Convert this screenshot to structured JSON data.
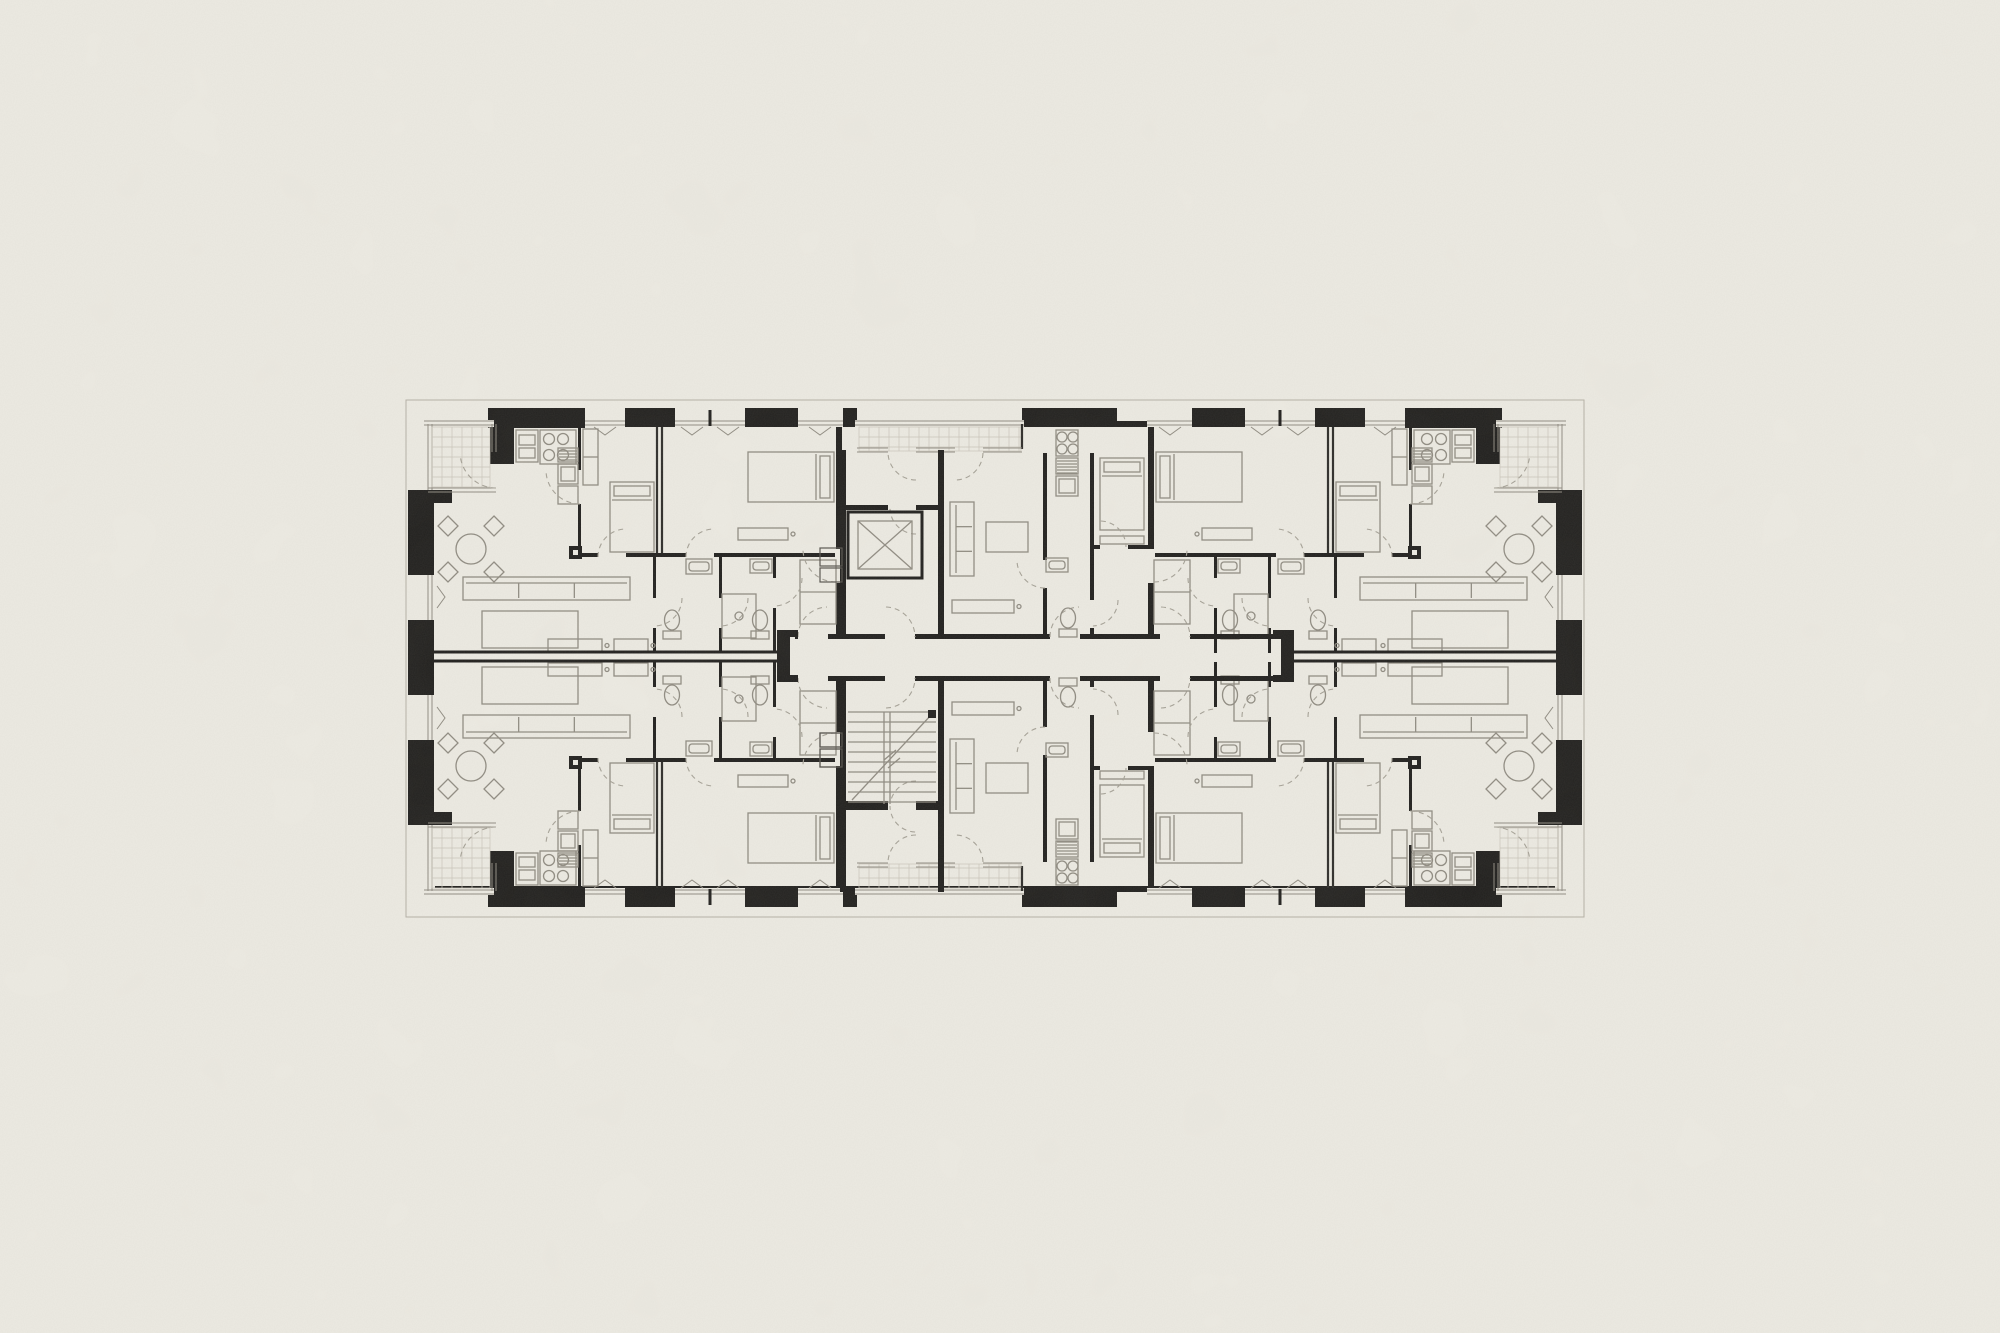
{
  "canvas": {
    "width": 2000,
    "height": 1333
  },
  "colors": {
    "paper": "#edebe3",
    "ink": "#1f1e1c",
    "furniture": "#8f8b81",
    "tile": "#c9c5ba"
  },
  "plan": {
    "x": 418,
    "y": 408,
    "width": 1154,
    "height": 499,
    "mirror_x": 995,
    "mirror_y": 657.5
  },
  "drawing": {
    "envelope": [
      [
        "r",
        406,
        400,
        1178,
        517,
        "prop"
      ],
      [
        "r",
        428,
        421,
        1134,
        6,
        "w"
      ],
      [
        "r",
        428,
        886,
        1134,
        6,
        "w"
      ],
      [
        "r",
        428,
        421,
        6,
        471,
        "w"
      ],
      [
        "r",
        1556,
        421,
        6,
        471,
        "w"
      ]
    ],
    "corner_apartment": [
      [
        "r",
        488,
        408,
        97,
        20,
        "w"
      ],
      [
        "r",
        490,
        428,
        24,
        36,
        "w"
      ],
      [
        "r",
        625,
        408,
        50,
        19,
        "w"
      ],
      [
        "r",
        745,
        408,
        53,
        19,
        "w"
      ],
      [
        "r",
        408,
        490,
        44,
        13,
        "w"
      ],
      [
        "r",
        408,
        503,
        24,
        72,
        "w"
      ],
      [
        "r",
        408,
        620,
        24,
        38,
        "w"
      ],
      [
        "r",
        578,
        427,
        3,
        129,
        "w"
      ],
      [
        "l",
        657,
        427,
        657,
        556,
        "t"
      ],
      [
        "l",
        662,
        427,
        662,
        556,
        "t"
      ],
      [
        "r",
        836,
        427,
        6,
        210,
        "w"
      ],
      [
        "r",
        578,
        553,
        264,
        4,
        "w"
      ],
      [
        "r",
        653,
        557,
        3,
        96,
        "w"
      ],
      [
        "r",
        719,
        557,
        3,
        96,
        "w"
      ],
      [
        "r",
        773,
        557,
        3,
        96,
        "w"
      ],
      [
        "r",
        577,
        470,
        5,
        34,
        "p"
      ],
      [
        "r",
        835,
        549,
        8,
        34,
        "p"
      ],
      [
        "r",
        598,
        553,
        28,
        4,
        "p"
      ],
      [
        "r",
        686,
        553,
        28,
        4,
        "p"
      ],
      [
        "r",
        653,
        598,
        3,
        30,
        "p"
      ],
      [
        "r",
        719,
        598,
        3,
        30,
        "p"
      ],
      [
        "r",
        773,
        578,
        3,
        30,
        "p"
      ],
      [
        "r",
        585,
        420,
        40,
        7,
        "p"
      ],
      [
        "dh",
        585,
        625,
        423
      ],
      [
        "vent",
        605,
        427,
        "s"
      ],
      [
        "r",
        675,
        420,
        70,
        7,
        "p"
      ],
      [
        "dh",
        675,
        745,
        423
      ],
      [
        "l",
        710,
        410,
        710,
        426,
        "t3"
      ],
      [
        "vent",
        692,
        427,
        "s"
      ],
      [
        "vent",
        728,
        427,
        "s"
      ],
      [
        "r",
        798,
        420,
        45,
        7,
        "p"
      ],
      [
        "dh",
        798,
        843,
        423
      ],
      [
        "vent",
        820,
        427,
        "s"
      ],
      [
        "r",
        427,
        575,
        8,
        45,
        "p"
      ],
      [
        "dv",
        430,
        575,
        620
      ],
      [
        "vent",
        437,
        597,
        "e"
      ],
      [
        "r",
        424,
        420,
        70,
        7,
        "p"
      ],
      [
        "r",
        427,
        424,
        8,
        66,
        "p"
      ],
      [
        "dh",
        424,
        494,
        423
      ],
      [
        "dv",
        430,
        424,
        490
      ],
      [
        "tiles",
        432,
        427,
        58,
        60,
        10
      ],
      [
        "dv",
        494,
        424,
        452
      ],
      [
        "dh",
        428,
        496,
        490
      ],
      [
        "a",
        496,
        452,
        36,
        90,
        172
      ],
      [
        "r",
        516,
        430,
        22,
        32,
        "f"
      ],
      [
        "r",
        519,
        435,
        16,
        10,
        "f"
      ],
      [
        "r",
        519,
        448,
        16,
        10,
        "f"
      ],
      [
        "r",
        540,
        430,
        36,
        34,
        "f"
      ],
      [
        "c",
        549,
        439,
        5.5,
        "f"
      ],
      [
        "c",
        563,
        439,
        5.5,
        "f"
      ],
      [
        "c",
        549,
        455,
        5.5,
        "f"
      ],
      [
        "c",
        563,
        455,
        5.5,
        "f"
      ],
      [
        "r",
        558,
        448,
        20,
        14,
        "f"
      ],
      [
        "hatch",
        558,
        448,
        20,
        14,
        3
      ],
      [
        "r",
        558,
        464,
        20,
        20,
        "f"
      ],
      [
        "r",
        561,
        467,
        14,
        14,
        "f"
      ],
      [
        "r",
        558,
        486,
        20,
        18,
        "f"
      ],
      [
        "table4",
        471,
        549
      ],
      [
        "sofa",
        463,
        577,
        167,
        23,
        "n"
      ],
      [
        "r",
        482,
        611,
        96,
        37,
        "f"
      ],
      [
        "r",
        583,
        429,
        15,
        56,
        "f"
      ],
      [
        "l",
        583,
        457,
        598,
        457,
        "f"
      ],
      [
        "bed",
        610,
        482,
        44,
        70,
        "n"
      ],
      [
        "bed",
        748,
        452,
        86,
        50,
        "e"
      ],
      [
        "desk",
        738,
        528,
        50,
        12
      ],
      [
        "r",
        800,
        560,
        36,
        64,
        "f"
      ],
      [
        "l",
        800,
        592,
        836,
        592,
        "f"
      ],
      [
        "sink",
        686,
        559,
        26,
        15
      ],
      [
        "wc",
        672,
        622,
        "s"
      ],
      [
        "shower",
        722,
        594,
        34,
        44
      ],
      [
        "wc",
        760,
        622,
        "s"
      ],
      [
        "sink",
        750,
        559,
        22,
        14
      ],
      [
        "desk",
        548,
        639,
        54,
        13
      ],
      [
        "desk",
        614,
        639,
        34,
        13
      ],
      [
        "sq",
        569,
        546,
        13
      ],
      [
        "a",
        580,
        470,
        34,
        90,
        180
      ],
      [
        "a",
        626,
        557,
        28,
        180,
        268
      ],
      [
        "a",
        714,
        557,
        28,
        180,
        268
      ],
      [
        "a",
        654,
        598,
        28,
        0,
        88
      ],
      [
        "a",
        720,
        598,
        28,
        0,
        88
      ],
      [
        "a",
        774,
        578,
        28,
        0,
        88
      ],
      [
        "a",
        836,
        549,
        33,
        90,
        178
      ]
    ],
    "middle_band": [
      [
        "r",
        843,
        408,
        14,
        19,
        "w"
      ],
      [
        "r",
        1022,
        408,
        95,
        19,
        "w"
      ],
      [
        "r",
        855,
        420,
        169,
        7,
        "p"
      ],
      [
        "dh",
        855,
        1024,
        423
      ],
      [
        "tiles",
        859,
        427,
        162,
        24,
        10
      ],
      [
        "l",
        1022,
        424,
        1022,
        449,
        "t"
      ],
      [
        "dh",
        857,
        888,
        450
      ],
      [
        "dh",
        916,
        955,
        450
      ],
      [
        "dh",
        983,
        1022,
        450
      ],
      [
        "a",
        916,
        452,
        28,
        90,
        178
      ],
      [
        "a",
        955,
        452,
        28,
        2,
        90
      ],
      [
        "r",
        840,
        450,
        6,
        188,
        "w"
      ],
      [
        "r",
        938,
        450,
        6,
        188,
        "w"
      ],
      [
        "r",
        846,
        505,
        92,
        5,
        "w"
      ],
      [
        "r",
        888,
        505,
        28,
        5,
        "p"
      ],
      [
        "a",
        916,
        508,
        26,
        90,
        178
      ],
      [
        "r",
        820,
        548,
        22,
        18,
        "d"
      ],
      [
        "r",
        820,
        568,
        22,
        14,
        "d"
      ],
      [
        "r",
        795,
        634,
        486,
        5,
        "w"
      ],
      [
        "r",
        798,
        634,
        30,
        5,
        "p"
      ],
      [
        "r",
        885,
        634,
        30,
        5,
        "p"
      ],
      [
        "r",
        1050,
        634,
        30,
        5,
        "p"
      ],
      [
        "r",
        1160,
        634,
        30,
        5,
        "p"
      ],
      [
        "a",
        828,
        637,
        30,
        180,
        268
      ],
      [
        "a",
        885,
        637,
        30,
        272,
        360
      ],
      [
        "a",
        1080,
        637,
        30,
        180,
        268
      ],
      [
        "a",
        1160,
        637,
        30,
        272,
        360
      ],
      [
        "r",
        1043,
        453,
        4,
        184,
        "w"
      ],
      [
        "r",
        1043,
        560,
        4,
        28,
        "p"
      ],
      [
        "r",
        1090,
        453,
        4,
        184,
        "w"
      ],
      [
        "r",
        1090,
        600,
        4,
        28,
        "p"
      ],
      [
        "r",
        1094,
        545,
        54,
        4,
        "w"
      ],
      [
        "r",
        1100,
        545,
        28,
        4,
        "p"
      ],
      [
        "r",
        1056,
        430,
        22,
        26,
        "f"
      ],
      [
        "c",
        1062,
        437,
        5,
        "f"
      ],
      [
        "c",
        1073,
        437,
        5,
        "f"
      ],
      [
        "c",
        1062,
        449,
        5,
        "f"
      ],
      [
        "c",
        1073,
        449,
        5,
        "f"
      ],
      [
        "r",
        1056,
        458,
        22,
        16,
        "f"
      ],
      [
        "hatch",
        1056,
        458,
        22,
        16,
        3
      ],
      [
        "r",
        1056,
        476,
        22,
        20,
        "f"
      ],
      [
        "r",
        1059,
        479,
        16,
        14,
        "f"
      ],
      [
        "sofa",
        950,
        502,
        24,
        74,
        "w"
      ],
      [
        "r",
        986,
        522,
        42,
        30,
        "f"
      ],
      [
        "desk",
        952,
        600,
        62,
        13
      ],
      [
        "bed",
        1100,
        458,
        44,
        72,
        "n"
      ],
      [
        "r",
        1100,
        536,
        44,
        8,
        "f"
      ],
      [
        "sink",
        1046,
        558,
        22,
        14
      ],
      [
        "wc",
        1068,
        620,
        "s"
      ],
      [
        "a",
        1045,
        560,
        28,
        90,
        178
      ],
      [
        "a",
        1100,
        547,
        26,
        272,
        360
      ],
      [
        "a",
        1092,
        600,
        26,
        0,
        88
      ]
    ],
    "party_walls": [
      [
        "l",
        432,
        652,
        777,
        652,
        "t3"
      ],
      [
        "l",
        432,
        661,
        777,
        661,
        "t3"
      ],
      [
        "l",
        1294,
        652,
        1560,
        652,
        "t3"
      ],
      [
        "l",
        1294,
        661,
        1560,
        661,
        "t3"
      ],
      [
        "r",
        777,
        630,
        13,
        52,
        "w"
      ],
      [
        "r",
        790,
        630,
        8,
        7,
        "w"
      ],
      [
        "r",
        790,
        675,
        8,
        7,
        "w"
      ],
      [
        "r",
        1281,
        630,
        13,
        52,
        "w"
      ],
      [
        "r",
        1273,
        630,
        8,
        7,
        "w"
      ],
      [
        "r",
        1273,
        675,
        8,
        7,
        "w"
      ]
    ],
    "elevator": [
      [
        "r",
        848,
        512,
        74,
        66,
        "wl"
      ],
      [
        "r",
        858,
        521,
        54,
        48,
        "f"
      ],
      [
        "l",
        858,
        521,
        912,
        569,
        "f"
      ],
      [
        "l",
        858,
        569,
        912,
        521,
        "f"
      ]
    ],
    "stairs": [
      [
        "r",
        840,
        677,
        6,
        215,
        "w"
      ],
      [
        "r",
        938,
        677,
        6,
        215,
        "w"
      ],
      [
        "r",
        846,
        801,
        92,
        5,
        "w"
      ],
      [
        "r",
        888,
        801,
        28,
        5,
        "p"
      ],
      [
        "a",
        916,
        806,
        26,
        92,
        180
      ],
      [
        "r",
        820,
        749,
        22,
        18,
        "d"
      ],
      [
        "r",
        820,
        733,
        22,
        14,
        "d"
      ],
      [
        "flight",
        848,
        712,
        88,
        92,
        10
      ],
      [
        "r",
        928,
        710,
        8,
        8,
        "w"
      ]
    ]
  }
}
